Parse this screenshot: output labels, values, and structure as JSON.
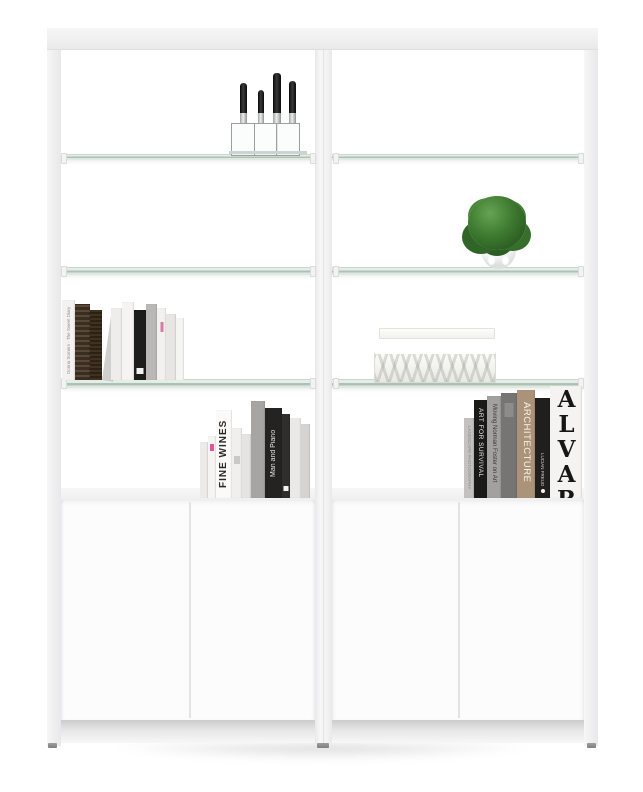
{
  "image_type": "product photograph",
  "subject": "white two-bay shelving wall unit with glass shelves over two-door storage cabinets",
  "unit": {
    "bays": 2,
    "glass_shelves_per_bay": 3,
    "cabinets": 2,
    "doors_per_cabinet": 2,
    "frame_color": "#f2f2f3",
    "glass_edge_color": "#a9bfae",
    "glass_surface_color": "#dfe9e2",
    "door_color": "#fcfcfd"
  },
  "decor": {
    "knife_block": {
      "label": "knife block",
      "knife_count": 4
    },
    "plant": {
      "label": "green plant in round white pot",
      "foliage_color": "#3d7a30",
      "pot_color": "#f4f5f5"
    },
    "storage_boxes": {
      "label": "two stacked patterned storage boxes",
      "count": 2
    },
    "book_groups": [
      {
        "location": "lower glass shelf, left bay",
        "count": 11
      },
      {
        "location": "left cabinet top",
        "count": 10
      },
      {
        "location": "right cabinet top",
        "count": 7
      }
    ]
  },
  "book_titles": {
    "left_shelf": {
      "diary": "Donna Somers · The Sweet Diary"
    },
    "left_cabinet": {
      "fine_wines": "FINE WINES",
      "man_and_piano": "Man and Piano"
    },
    "right_cabinet": {
      "landscape": "LANDSCAPE PHOTOGRAPHY",
      "art_for_survival": "ART FOR SURVIVAL",
      "norman_foster": "Moving Norman Foster on Art",
      "architecture": "ARCHITECTURE",
      "lucian_freud": "LUCIAN FREUD",
      "alvar": "ALVAR"
    }
  },
  "accents": {
    "pink_mark": "#e0559a",
    "architecture_tan": "#ab9379",
    "knife_handle": "#0a0a0a"
  }
}
